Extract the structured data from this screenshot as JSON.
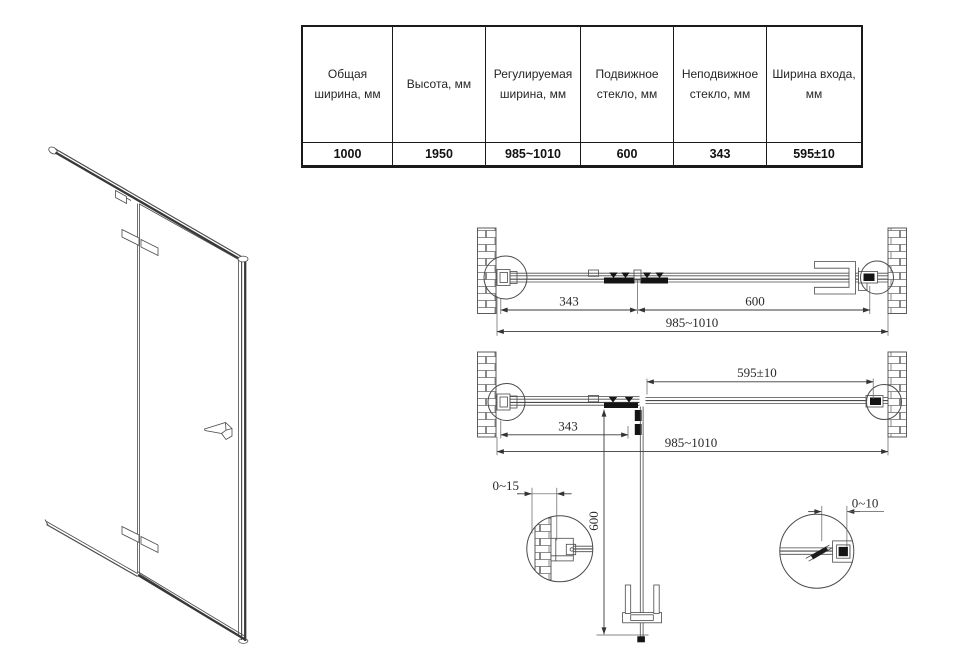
{
  "spec_table": {
    "columns": [
      {
        "header": "Общая ширина, мм",
        "value": "1000"
      },
      {
        "header": "Высота, мм",
        "value": "1950"
      },
      {
        "header": "Регулируемая ширина, мм",
        "value": "985~1010"
      },
      {
        "header": "Подвижное стекло, мм",
        "value": "600"
      },
      {
        "header": "Неподвижное стекло, мм",
        "value": "343"
      },
      {
        "header": "Ширина входа, мм",
        "value": "595±10"
      }
    ]
  },
  "top_view_closed": {
    "dim_fixed_glass": "343",
    "dim_moving_glass": "600",
    "dim_total_width": "985~1010"
  },
  "top_view_open": {
    "dim_entrance_width": "595±10",
    "dim_fixed_glass": "343",
    "dim_total_width": "985~1010"
  },
  "detail_views": {
    "dim_left_wall_adjust": "0~15",
    "dim_door_glass_width": "600",
    "dim_right_wall_adjust": "0~10"
  },
  "colors": {
    "background": "#ffffff",
    "line": "#4a4a4a",
    "dim_text": "#2a2a2a",
    "table_border": "#1a1a1a",
    "hardware_fill": "#141414"
  }
}
